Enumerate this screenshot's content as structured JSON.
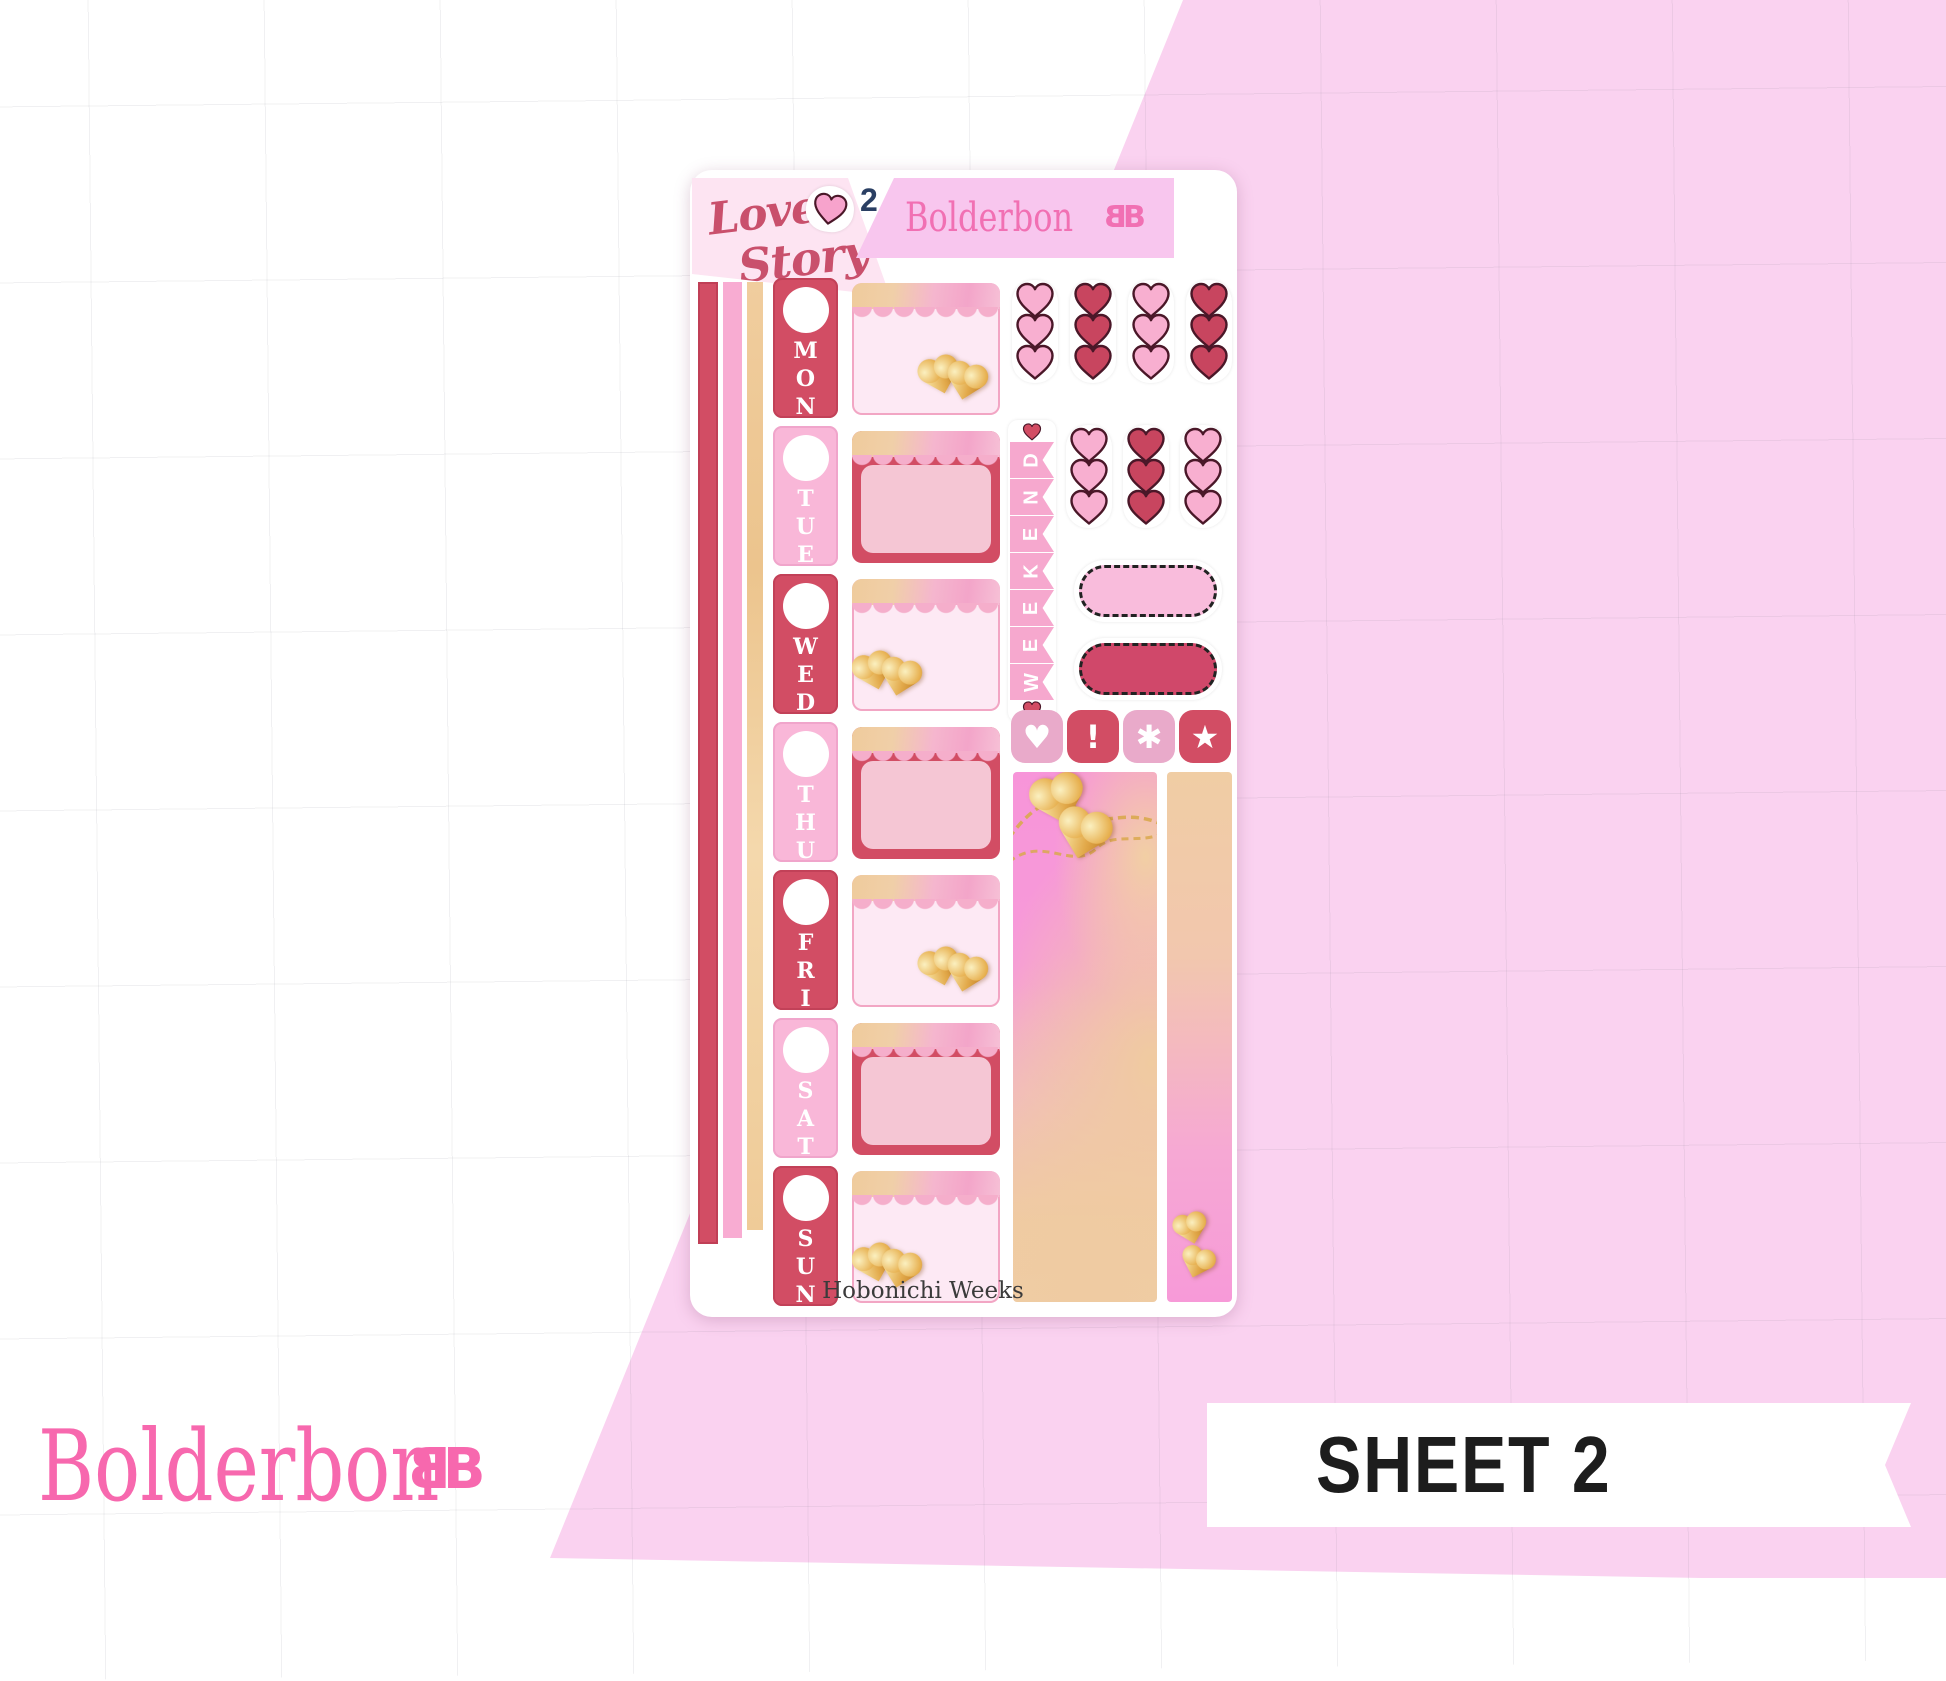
{
  "branding": {
    "name": "Bolderbon"
  },
  "page": {
    "sheet_tag_label": "SHEET 2",
    "background_accent_color": "#FAD2F0",
    "brand_pink": "#F768AE"
  },
  "sheet": {
    "kit_title_line1": "Love",
    "kit_title_line2": "Story",
    "sheet_number": "2",
    "footer_label": "Hobonichi Weeks",
    "days": [
      {
        "label": "MON",
        "variant": "red",
        "box": "light",
        "hearts": "right"
      },
      {
        "label": "TUE",
        "variant": "pink",
        "box": "bordered",
        "hearts": "none"
      },
      {
        "label": "WED",
        "variant": "red",
        "box": "light",
        "hearts": "left"
      },
      {
        "label": "THU",
        "variant": "pink",
        "box": "bordered",
        "hearts": "none"
      },
      {
        "label": "FRI",
        "variant": "red",
        "box": "light",
        "hearts": "right"
      },
      {
        "label": "SAT",
        "variant": "pink",
        "box": "bordered",
        "hearts": "none"
      },
      {
        "label": "SUN",
        "variant": "red",
        "box": "light",
        "hearts": "left"
      }
    ],
    "heart_grid_top": [
      "pink",
      "red",
      "pink",
      "red"
    ],
    "heart_grid_mid": [
      "pink",
      "red",
      "pink"
    ],
    "weekend_label": "WEEKEND",
    "icon_squares": [
      {
        "icon": "heart",
        "color": "mauve"
      },
      {
        "icon": "exclamation",
        "color": "red"
      },
      {
        "icon": "asterisk",
        "color": "mauve"
      },
      {
        "icon": "star",
        "color": "red"
      }
    ],
    "colors": {
      "day_red": "#D24D64",
      "day_pink": "#F9B7D8",
      "heart_pink": "#F8AFD0",
      "heart_red": "#C8455F",
      "heart_outline": "#4A1728",
      "scallop_pink": "#F5AECB",
      "washi_tan": "#EFCB98",
      "gold": "#E2A94A",
      "banner_pink": "#F8C6EE",
      "title_red": "#C9506C",
      "number_navy": "#2A3F63"
    }
  }
}
